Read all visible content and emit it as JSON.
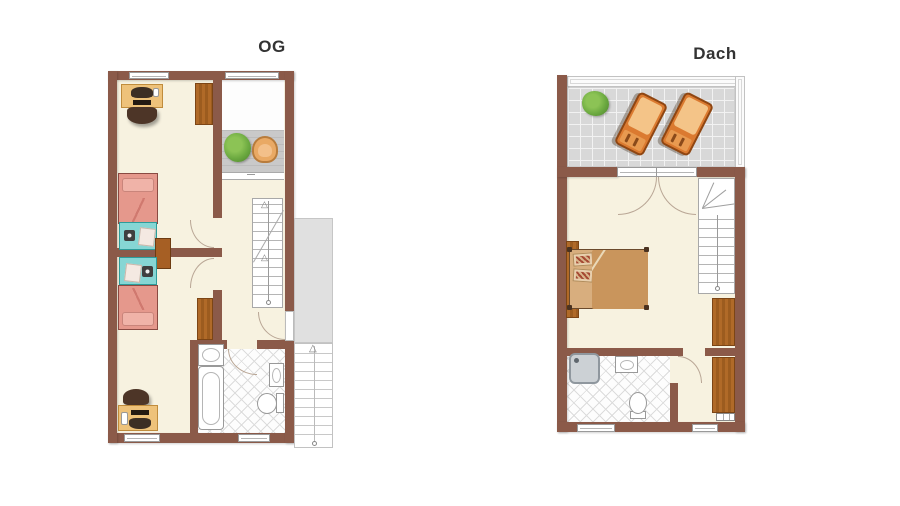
{
  "plans": [
    {
      "label": "OG",
      "type": "floor-plan",
      "elements": [
        "desk-with-computer",
        "desk-chair",
        "wardrobe",
        "single-bed",
        "single-bed",
        "nightstand",
        "desk-with-computer",
        "desk-chair",
        "wardrobe",
        "washbasin-counter",
        "bathtub",
        "wall-sink",
        "toilet",
        "internal-staircase",
        "balcony-deck",
        "plant",
        "wicker-chair",
        "external-landing",
        "external-staircase"
      ]
    },
    {
      "label": "Dach",
      "type": "floor-plan",
      "elements": [
        "roof-terrace",
        "plant",
        "sun-lounger",
        "sun-lounger",
        "french-doors",
        "double-bed",
        "headboard-shelf",
        "winder-staircase",
        "wardrobe",
        "wardrobe",
        "radiator",
        "shower",
        "sink",
        "toilet"
      ]
    }
  ],
  "glyphs": {
    "up_arrow": "△"
  },
  "colors": {
    "wall": "#8b5a49",
    "floor": "#f7f2e0",
    "wood": "#b06a28",
    "wood_dark": "#7c4515",
    "bed_pink": "#e5988c",
    "turquoise": "#86d6d4",
    "desk_tan": "#eec27a",
    "chair_brown": "#4d3527",
    "lounger_orange": "#db7a30",
    "cushion": "#f4c488",
    "tile_gray": "#d8d8d8",
    "deck_gray": "#c9c9c9",
    "plant_green": "#6aa83f",
    "fixture_border": "#999999",
    "stair_line": "#b5b5b5",
    "bed_tan": "#d8ae7e",
    "blanket_tan": "#c9955c",
    "platform_gray": "#e0e0e0",
    "lattice": "#dcdcdc",
    "arc": "#b9a695",
    "title_text": "#333333"
  }
}
